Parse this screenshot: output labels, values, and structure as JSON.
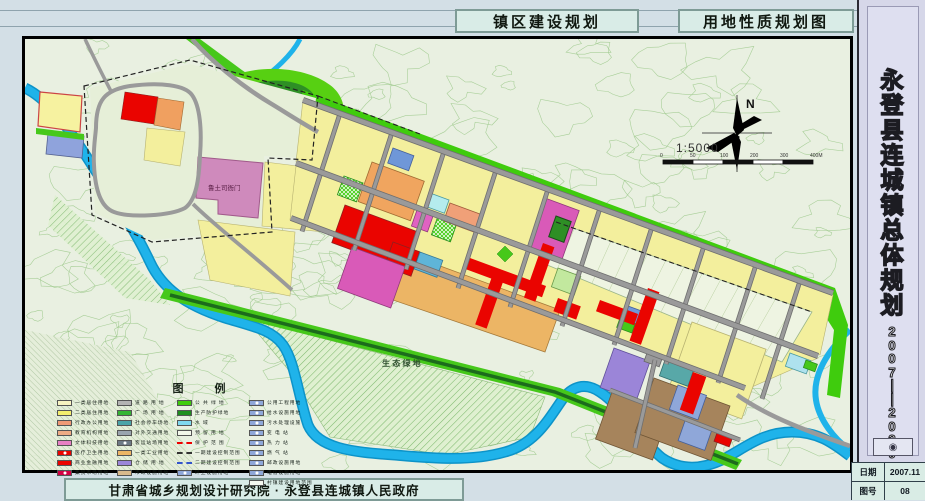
{
  "header": {
    "title_left": "镇区建设规划",
    "title_right": "用地性质规划图"
  },
  "sidebar": {
    "title": "永登县连城镇总体规划",
    "years": "2007——2020",
    "stamp": "◉",
    "info": [
      {
        "label": "日期",
        "value": "2007.11"
      },
      {
        "label": "图号",
        "value": "08"
      }
    ]
  },
  "footer": {
    "credit": "甘肃省城乡规划设计研究院 · 永登县连城镇人民政府"
  },
  "map": {
    "labels": {
      "north": "N",
      "scale": "1:5000",
      "scale_ticks": [
        "0",
        "50",
        "100",
        "200",
        "300",
        "400M"
      ],
      "old_town": "鲁土司衙门",
      "eco_green": "生 态 绿 地"
    },
    "legend": {
      "title": "图 例",
      "columns": [
        {
          "items": [
            {
              "label": "一类居住用地",
              "kind": "box",
              "color": "#f7f3c0"
            },
            {
              "label": "二类居住用地",
              "kind": "box",
              "color": "#f3ee6e"
            },
            {
              "label": "行政办公用地",
              "kind": "box",
              "color": "#f09a76"
            },
            {
              "label": "教育机构用地",
              "kind": "box",
              "color": "#eeab84"
            },
            {
              "label": "文体科技用地",
              "kind": "box",
              "color": "#e87fc4"
            },
            {
              "label": "医疗卫生用地",
              "kind": "box-icon",
              "color": "#ea0400"
            },
            {
              "label": "商业金融用地",
              "kind": "box",
              "color": "#ea0400"
            },
            {
              "label": "集贸市场用地",
              "kind": "box-icon",
              "color": "#d40044"
            }
          ]
        },
        {
          "items": [
            {
              "label": "道 路 用 地",
              "kind": "box",
              "color": "#b3b3b3"
            },
            {
              "label": "广 场 用 地",
              "kind": "box",
              "color": "#35b535"
            },
            {
              "label": "社会停车场地",
              "kind": "box",
              "color": "#4aa4a8"
            },
            {
              "label": "对外交通用地",
              "kind": "box",
              "color": "#9aa4ae"
            },
            {
              "label": "客运站场用地",
              "kind": "box-icon",
              "color": "#6e7a86"
            },
            {
              "label": "一类工业用地",
              "kind": "box",
              "color": "#ecb565"
            },
            {
              "label": "仓 储 用 地",
              "kind": "box",
              "color": "#9b85d8"
            },
            {
              "label": "市政设施用地",
              "kind": "box",
              "color": "#d9b98c"
            }
          ]
        },
        {
          "items": [
            {
              "label": "公 共 绿 地",
              "kind": "box",
              "color": "#3fcc0d"
            },
            {
              "label": "生产防护绿地",
              "kind": "box",
              "color": "#1f8f1f"
            },
            {
              "label": "水        域",
              "kind": "box",
              "color": "#7fd9f0"
            },
            {
              "label": "预 留 用 地",
              "kind": "box",
              "color": "#f2f7ea"
            },
            {
              "label": "保 护 范 围",
              "kind": "dash",
              "color": "#ee0000"
            },
            {
              "label": "一期建设控制范围",
              "kind": "dash",
              "color": "#333333"
            },
            {
              "label": "二期建设控制范围",
              "kind": "dash",
              "color": "#3355cc"
            },
            {
              "label": "环卫设施用地",
              "kind": "box-icon",
              "color": "#8fa7d9"
            }
          ]
        },
        {
          "items": [
            {
              "label": "公用工程用地",
              "kind": "box-icon",
              "color": "#8fa7d9"
            },
            {
              "label": "给水设施用地",
              "kind": "box-icon",
              "color": "#8fa7d9"
            },
            {
              "label": "污水处理设施",
              "kind": "box-icon",
              "color": "#8fa7d9"
            },
            {
              "label": "变  电  站",
              "kind": "box-icon",
              "color": "#8fa7d9"
            },
            {
              "label": "热  力  站",
              "kind": "box-icon",
              "color": "#8fa7d9"
            },
            {
              "label": "燃  气  站",
              "kind": "box-icon",
              "color": "#8fa7d9"
            },
            {
              "label": "邮政设施用地",
              "kind": "box-icon",
              "color": "#8fa7d9"
            },
            {
              "label": "电信设施用地",
              "kind": "box-icon",
              "color": "#8fa7d9"
            },
            {
              "label": "村镇建设用地范围",
              "kind": "box",
              "color": "#f5f8f0"
            }
          ]
        }
      ]
    }
  },
  "colors": {
    "paper": "#e9f0e1",
    "contour": "#9ec98c",
    "river": "#1fb3ea",
    "green_public": "#3fcc0d",
    "green_dark": "#2e8f25",
    "residential": "#f3ef9d",
    "commercial_red": "#ea0400",
    "market_magenta": "#d95ab8",
    "admin_orange": "#f0a55f",
    "industry_orange": "#ecb565",
    "warehouse_purple": "#9b85d8",
    "municipal_tan": "#a6845c",
    "utility_blue": "#8fa7d9",
    "historic_pink": "#cf8abc",
    "road_gray": "#9a9a9a"
  }
}
